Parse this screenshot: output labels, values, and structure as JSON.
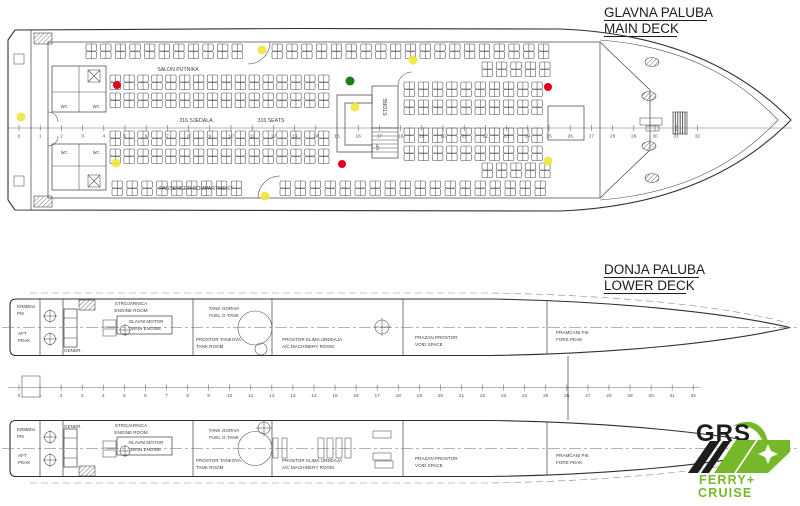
{
  "main_deck": {
    "title_hr": "GLAVNA PALUBA",
    "title_en": "MAIN DECK",
    "salon_label": "SALON PUTNIKA",
    "seats_hr": "316 SJEDALA",
    "seats_en": "316 SEATS",
    "passenger_label": "PASSENGER COMPARTMENT",
    "store_label": "STORE",
    "up_label": "UP",
    "wc_label": "WC",
    "frames": {
      "min": 0,
      "max": 32
    }
  },
  "lower_deck": {
    "title_hr": "DONJA PALUBA",
    "title_en": "LOWER DECK",
    "frames": {
      "min": 0,
      "max": 32
    },
    "compartments": {
      "aft_peak": {
        "hr1": "KRMENI",
        "hr2": "PIK",
        "en1": "AFT",
        "en2": "PEAK"
      },
      "engine_room": {
        "hr": "STROJARNICA",
        "en": "ENGINE ROOM"
      },
      "generator": "GENER.",
      "main_engine": {
        "hr": "GLAVNI MOTOR",
        "en": "MAIN ENGINE"
      },
      "fuel_tank": {
        "hr": "TANK GORIVA",
        "en": "FUEL O.TANK"
      },
      "tank_room": {
        "hr": "PROSTOR TANKOVA",
        "en": "TANK ROOM"
      },
      "ac_room": {
        "hr": "PROSTOR KLIMA UREĐAJA",
        "en": "A/C MACHINERY ROOM"
      },
      "void_space": {
        "hr": "PRAZAN PROSTOR",
        "en": "VOID SPACE"
      },
      "fore_peak": {
        "hr": "PRAMČANI PIK",
        "en": "FORE PEAK"
      }
    }
  },
  "markers": {
    "red": "#e2001a",
    "green": "#1e7d1e",
    "yellow": "#f0e53c"
  },
  "logo": {
    "brand": "GRS",
    "line1": "FERRY+",
    "line2": "CRUISE",
    "green": "#76b82a",
    "black": "#1d1d1b"
  }
}
